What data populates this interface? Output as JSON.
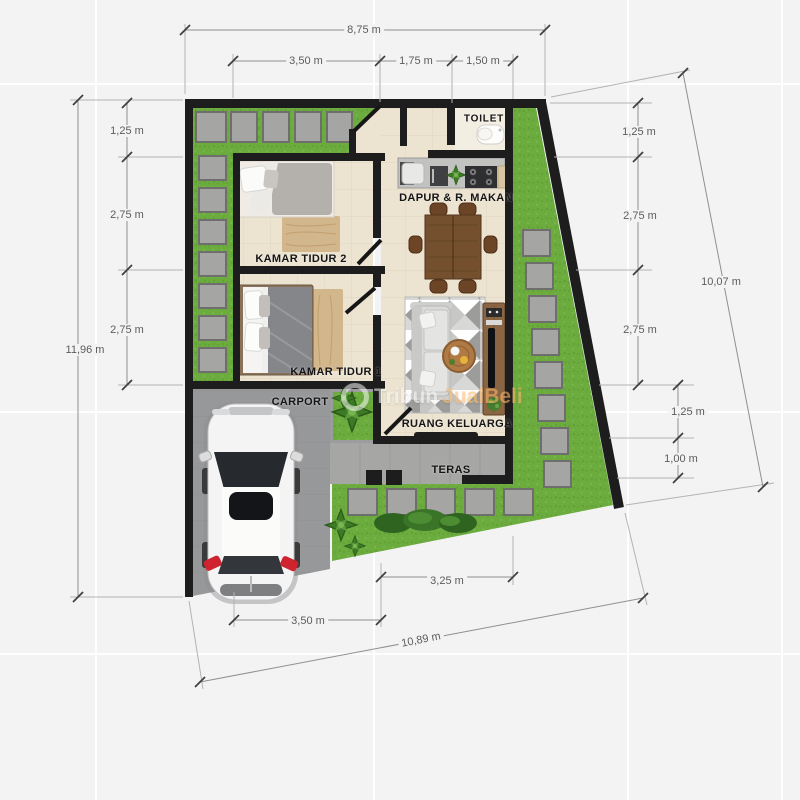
{
  "rooms": {
    "toilet": "TOILET",
    "kitchen_dining": "DAPUR & R. MAKAN",
    "bedroom2": "KAMAR TIDUR 2",
    "bedroom1": "KAMAR TIDUR 1",
    "family_room": "RUANG KELUARGA",
    "carport": "CARPORT",
    "terrace": "TERAS"
  },
  "dimensions": {
    "unit": "m",
    "top_total": "8,75 m",
    "top_segments": [
      "3,50 m",
      "1,75 m",
      "1,50 m"
    ],
    "left_total": "11,96 m",
    "left_segments": [
      "1,25 m",
      "2,75 m",
      "2,75 m"
    ],
    "right_total": "10,07 m",
    "right_segments": [
      "1,25 m",
      "2,75 m",
      "2,75 m",
      "1,25 m",
      "1,00 m"
    ],
    "bottom_total": "10,89 m",
    "bottom_segments": [
      "3,25 m",
      "3,50 m"
    ]
  },
  "watermark": {
    "part1": "Tribun",
    "part2": "JualBeli"
  },
  "colors": {
    "grass": "#6cab3e",
    "wall": "#1d1d1d",
    "floor": "#ece3d0",
    "paving": "#97989a",
    "terrace_paving": "#a6a6a4",
    "stone": "#a5a5a3",
    "dimension_text": "#5c5c5c",
    "watermark_accent": "#ffb967"
  }
}
